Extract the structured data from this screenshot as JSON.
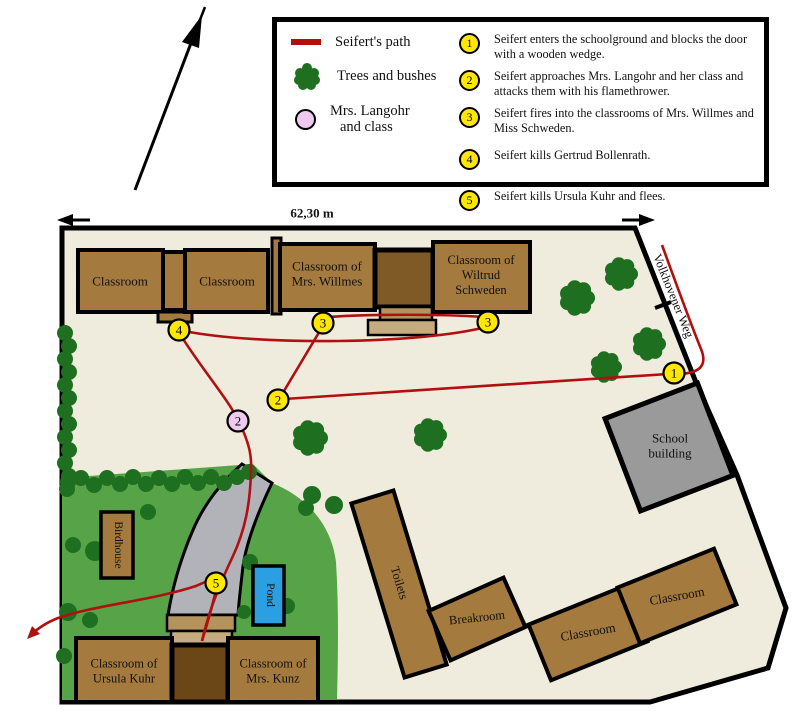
{
  "legend": {
    "path_label": "Seifert's path",
    "trees_label": "Trees and bushes",
    "langohr_l1": "Mrs. Langohr",
    "langohr_l2": "and class",
    "events": [
      {
        "num": "1",
        "text": "Seifert enters the schoolground and blocks the door with a wooden wedge."
      },
      {
        "num": "2",
        "text": "Seifert approaches Mrs. Langohr and her class and attacks them with his flamethrower."
      },
      {
        "num": "3",
        "text": "Seifert fires into the classrooms of Mrs. Willmes and Miss Schweden."
      },
      {
        "num": "4",
        "text": "Seifert kills Gertrud Bollenrath."
      },
      {
        "num": "5",
        "text": "Seifert kills Ursula Kuhr and flees."
      }
    ]
  },
  "map": {
    "labels": {
      "scale": "62,30 m",
      "street": "Volkhovener Weg",
      "classroom_nw1": "Classroom",
      "classroom_nw2": "Classroom",
      "willmes_l1": "Classroom of",
      "willmes_l2": "Mrs. Willmes",
      "schweden_l1": "Classroom of",
      "schweden_l2": "Wiltrud",
      "schweden_l3": "Schweden",
      "school_l1": "School",
      "school_l2": "building",
      "toilets": "Toilets",
      "breakroom": "Breakroom",
      "classroom_se1": "Classroom",
      "classroom_se2": "Classroom",
      "birdhouse": "Birdhouse",
      "pond": "Pond",
      "kuhr_l1": "Classroom of",
      "kuhr_l2": "Ursula Kuhr",
      "kunz_l1": "Classroom of",
      "kunz_l2": "Mrs. Kunz"
    },
    "colors": {
      "ground": "#f0ecdd",
      "building": "#a57a3e",
      "building_dark": "#7f5a26",
      "building_darker": "#6b4718",
      "porch_dark": "#b5935d",
      "porch_light": "#c4ac80",
      "school_gray": "#9a9a9a",
      "walkway_gray": "#b2b2b9",
      "grass": "#57a348",
      "tree": "#1e6f1f",
      "pond": "#2aa0e2",
      "path_red": "#b01010",
      "marker_yellow": "#ffe800",
      "marker_pink": "#eec9f0"
    },
    "markers": [
      {
        "num": "1",
        "x": 674,
        "y": 373,
        "kind": "event"
      },
      {
        "num": "2",
        "x": 278,
        "y": 400,
        "kind": "event"
      },
      {
        "num": "3",
        "x": 323,
        "y": 323,
        "kind": "event"
      },
      {
        "num": "3",
        "x": 488,
        "y": 322,
        "kind": "event"
      },
      {
        "num": "4",
        "x": 179,
        "y": 330,
        "kind": "event"
      },
      {
        "num": "5",
        "x": 216,
        "y": 583,
        "kind": "event"
      },
      {
        "num": "2",
        "x": 238,
        "y": 421,
        "kind": "langohr"
      }
    ],
    "path": {
      "road": "M662,245 C674,278 690,322 701,349 C706,361 703,369 692,372 C686,374 679,374 674,373",
      "s12": "M668,374 L284,399",
      "s23": "M281,396 L321,329",
      "s33": "M327,317 C370,314 440,314 484,317",
      "s34": "M486,327 C420,344 260,346 184,331",
      "s45": "M180,334 C198,364 228,399 238,420 C249,442 252,455 251,472 C250,505 245,530 233,556 C223,577 210,606 202,641",
      "exit": "M202,641 C209,618 214,600 217,585 C219,575 212,579 196,586 C150,601 95,605 58,618 C48,622 38,628 31,635"
    },
    "trees": [
      [
        577,
        298,
        18
      ],
      [
        621,
        274,
        17
      ],
      [
        649,
        344,
        17
      ],
      [
        606,
        367,
        16
      ],
      [
        310,
        438,
        18
      ],
      [
        430,
        435,
        17
      ]
    ],
    "bushes": [
      [
        65,
        333,
        8
      ],
      [
        69,
        346,
        8
      ],
      [
        65,
        359,
        8
      ],
      [
        69,
        372,
        8
      ],
      [
        65,
        385,
        8
      ],
      [
        69,
        398,
        8
      ],
      [
        65,
        411,
        8
      ],
      [
        69,
        424,
        8
      ],
      [
        65,
        437,
        8
      ],
      [
        69,
        450,
        8
      ],
      [
        65,
        463,
        8
      ],
      [
        69,
        476,
        8
      ],
      [
        67,
        489,
        8
      ],
      [
        68,
        482,
        8
      ],
      [
        81,
        478,
        8
      ],
      [
        94,
        485,
        8
      ],
      [
        107,
        478,
        8
      ],
      [
        120,
        484,
        8
      ],
      [
        133,
        477,
        8
      ],
      [
        146,
        484,
        8
      ],
      [
        159,
        478,
        8
      ],
      [
        172,
        484,
        8
      ],
      [
        185,
        477,
        8
      ],
      [
        198,
        483,
        8
      ],
      [
        211,
        477,
        8
      ],
      [
        224,
        483,
        8
      ],
      [
        237,
        477,
        8
      ],
      [
        249,
        472,
        8
      ],
      [
        95,
        551,
        10
      ],
      [
        73,
        545,
        8
      ],
      [
        148,
        512,
        8
      ],
      [
        68,
        612,
        9
      ],
      [
        90,
        620,
        8
      ],
      [
        64,
        656,
        8
      ],
      [
        250,
        562,
        8
      ],
      [
        287,
        606,
        8
      ],
      [
        244,
        612,
        7
      ],
      [
        312,
        495,
        9
      ],
      [
        306,
        508,
        8
      ],
      [
        334,
        505,
        9
      ]
    ]
  }
}
